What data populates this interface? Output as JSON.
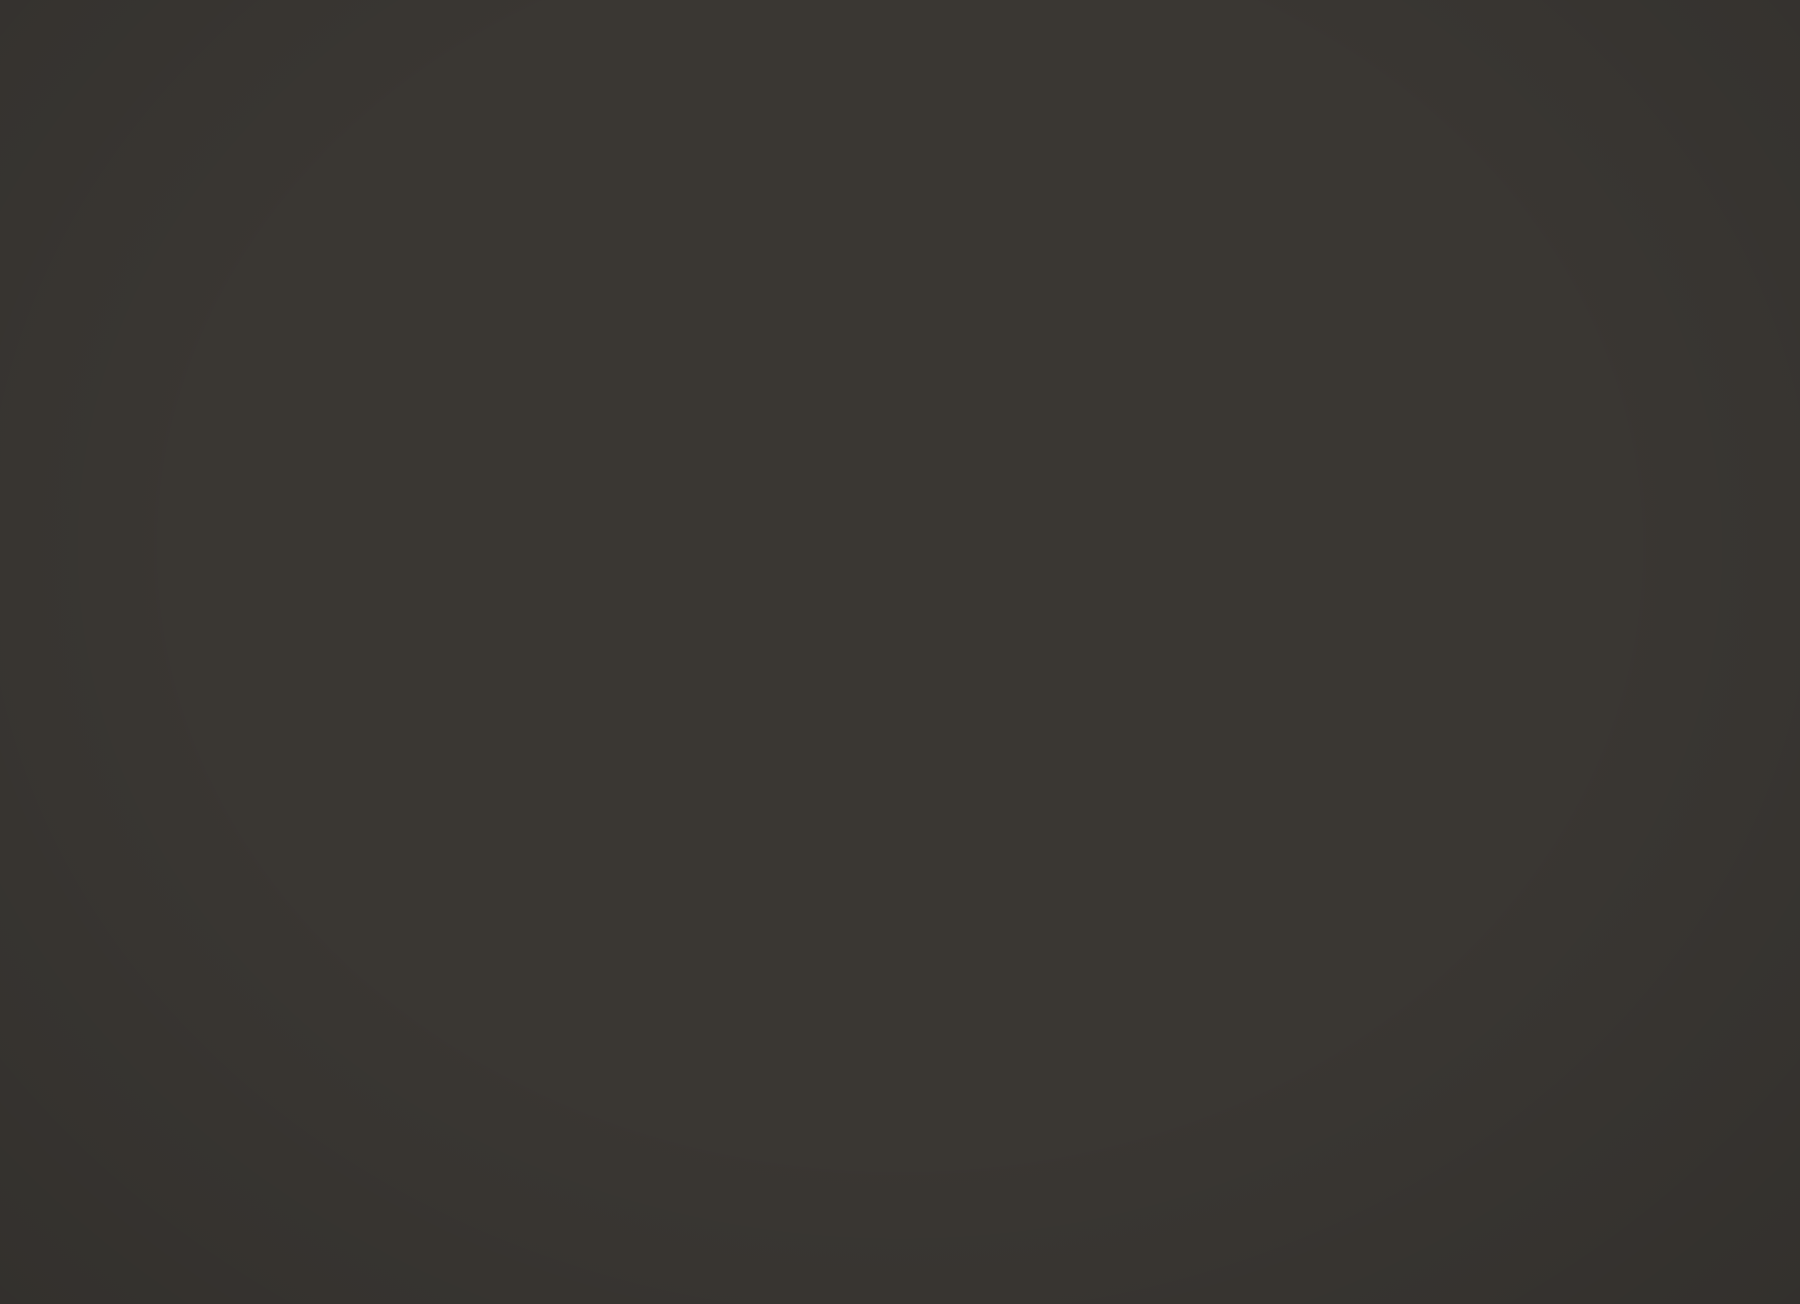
{
  "colors": {
    "ink": "#2c2a26",
    "paper": "#d8d5d0"
  },
  "header": {
    "art_number": "Art.323.101.6"
  },
  "diagram": {
    "amt": {
      "line1": "Amt",
      "line2": "Central",
      "numeral": "I"
    },
    "apparat1": {
      "line1": "Apparat",
      "line2": "Appareil",
      "sup": "1",
      "circuit_num": "1"
    },
    "apparat2": {
      "caption": "Apparat / Appareil 2",
      "num": "2"
    },
    "terminals": {
      "a": "a",
      "b": "b"
    },
    "wire_labels": {
      "w": "w",
      "bl": "bl",
      "wgb": "wgb",
      "gnw": "gnw",
      "blgb": "blgb",
      "blgn": "blgn",
      "blbn": "blbn",
      "bnw": "bnw",
      "guw": "guw",
      "blgu": "blgu"
    },
    "contacts": {
      "a1": {
        "base": "a",
        "sub": "1"
      },
      "a2": {
        "base": "a",
        "sub": "2"
      },
      "b1": {
        "base": "b",
        "sub": "1"
      },
      "b2": {
        "base": "b",
        "sub": "2"
      }
    },
    "capacitors": {
      "c1": {
        "name": "C1",
        "value": "3μ"
      },
      "c2": {
        "name": "C2",
        "value": "3μ"
      },
      "c3": {
        "name": "C3",
        "value": "3μ"
      },
      "c4": {
        "name": "C4",
        "value": "3μ"
      }
    },
    "relays": {
      "b1": {
        "winding": "B",
        "value": "45",
        "pin_left": "1",
        "pin_right": "2"
      },
      "b2": {
        "winding": "B",
        "value": "45",
        "pin_left": "4",
        "pin_right": "3"
      },
      "a1": {
        "winding": "A",
        "value": "45",
        "pin_top": "1",
        "pin_bottom": "2"
      },
      "a2": {
        "winding": "A",
        "value": "45",
        "pin_top": "4",
        "pin_bottom": "3"
      }
    }
  },
  "title_block": {
    "de_title": "Relaiskasten",
    "de_subtitle": "zur Parallelschaltung von Telefonapparaten",
    "fr_title": "Boîte à relais",
    "fr_subtitle": "pour montage en parallèle d'appareils téléphoniques",
    "org_line1": "GD PTT Fernmeldedienste",
    "org_line2": "DG PTT Services des télécommunications",
    "sheet_number": "7.3",
    "date": "25.9.51",
    "drawing_number": "Tf 3-36.891.a"
  }
}
